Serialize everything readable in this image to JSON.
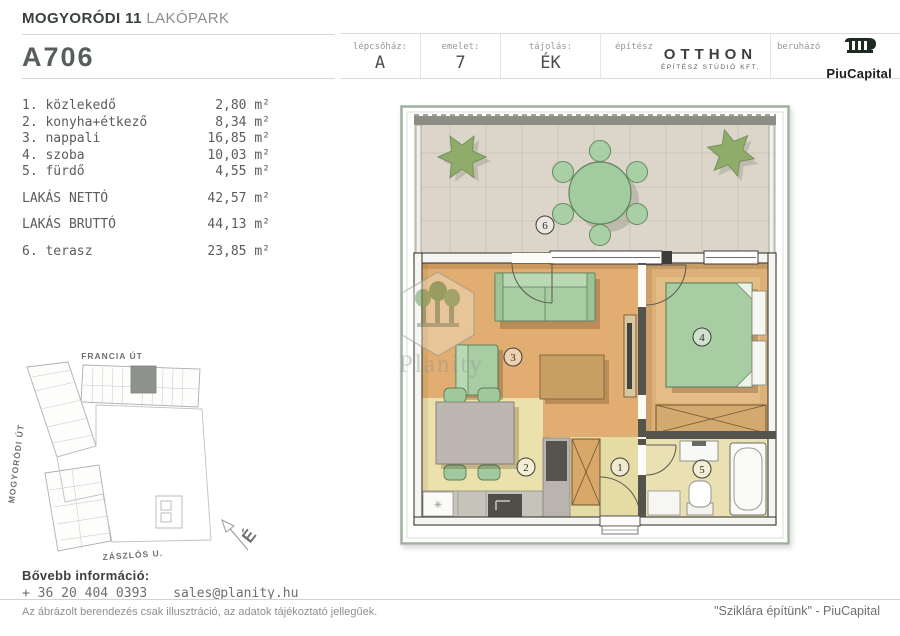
{
  "header": {
    "project": {
      "bold": "MOGYORÓDI 11",
      "light": " LAKÓPARK"
    },
    "unit_code": "A706",
    "cells": [
      {
        "label": "lépcsőház:",
        "value": "A"
      },
      {
        "label": "emelet:",
        "value": "7"
      },
      {
        "label": "tájolás:",
        "value": "ÉK"
      }
    ],
    "architect": {
      "label": "építész",
      "name": "OTTHON",
      "subtitle": "ÉPÍTÉSZ STÚDIÓ KFT."
    },
    "developer": {
      "label": "beruházó",
      "name": "PiuCapital"
    }
  },
  "room_list": {
    "items": [
      {
        "index": "1. ",
        "name": "közlekedő",
        "area": "2,80",
        "unit": " m²"
      },
      {
        "index": "2. ",
        "name": "konyha+étkező",
        "area": "8,34",
        "unit": " m²"
      },
      {
        "index": "3. ",
        "name": "nappali",
        "area": "16,85",
        "unit": " m²"
      },
      {
        "index": "4. ",
        "name": "szoba",
        "area": "10,03",
        "unit": " m²"
      },
      {
        "index": "5. ",
        "name": "fürdő",
        "area": "4,55",
        "unit": " m²"
      }
    ],
    "totals": [
      {
        "name": "LAKÁS NETTÓ",
        "area": "42,57",
        "unit": " m²"
      },
      {
        "name": "LAKÁS BRUTTÓ",
        "area": "44,13",
        "unit": " m²"
      }
    ],
    "extra": {
      "index": "6. ",
      "name": "terasz",
      "area": "23,85",
      "unit": " m²"
    }
  },
  "site_map": {
    "street_top": "FRANCIA ÚT",
    "street_left": "MOGYORÓDI ÚT",
    "street_bottom": "ZÁSZLÓS U.",
    "north_letter": "É"
  },
  "floor_plan": {
    "room_labels": {
      "hall": "1",
      "kitchen": "2",
      "living": "3",
      "bedroom": "4",
      "bath": "5",
      "terrace": "6"
    },
    "watermark": "Planity",
    "fridge_icon": "✳"
  },
  "footer": {
    "info_label": "Bővebb információ:",
    "phone": "+ 36 20 404 0393",
    "email": "sales@planity.hu",
    "disclaimer": "Az ábrázolt berendezés csak illusztráció, az adatok tájékoztató jellegűek.",
    "slogan": "\"Sziklára építünk\" - PiuCapital"
  },
  "colors": {
    "accent_green": "#a8cda3",
    "floor_tan": "#e1ad70",
    "floor_yellow": "#ebe1ad",
    "terrace_gray": "#dbd5ca",
    "wall_dark": "#55534d",
    "frame_sage": "#9fb09f",
    "site_highlight": "#8e938c",
    "logo_dark": "#1d2a22"
  }
}
